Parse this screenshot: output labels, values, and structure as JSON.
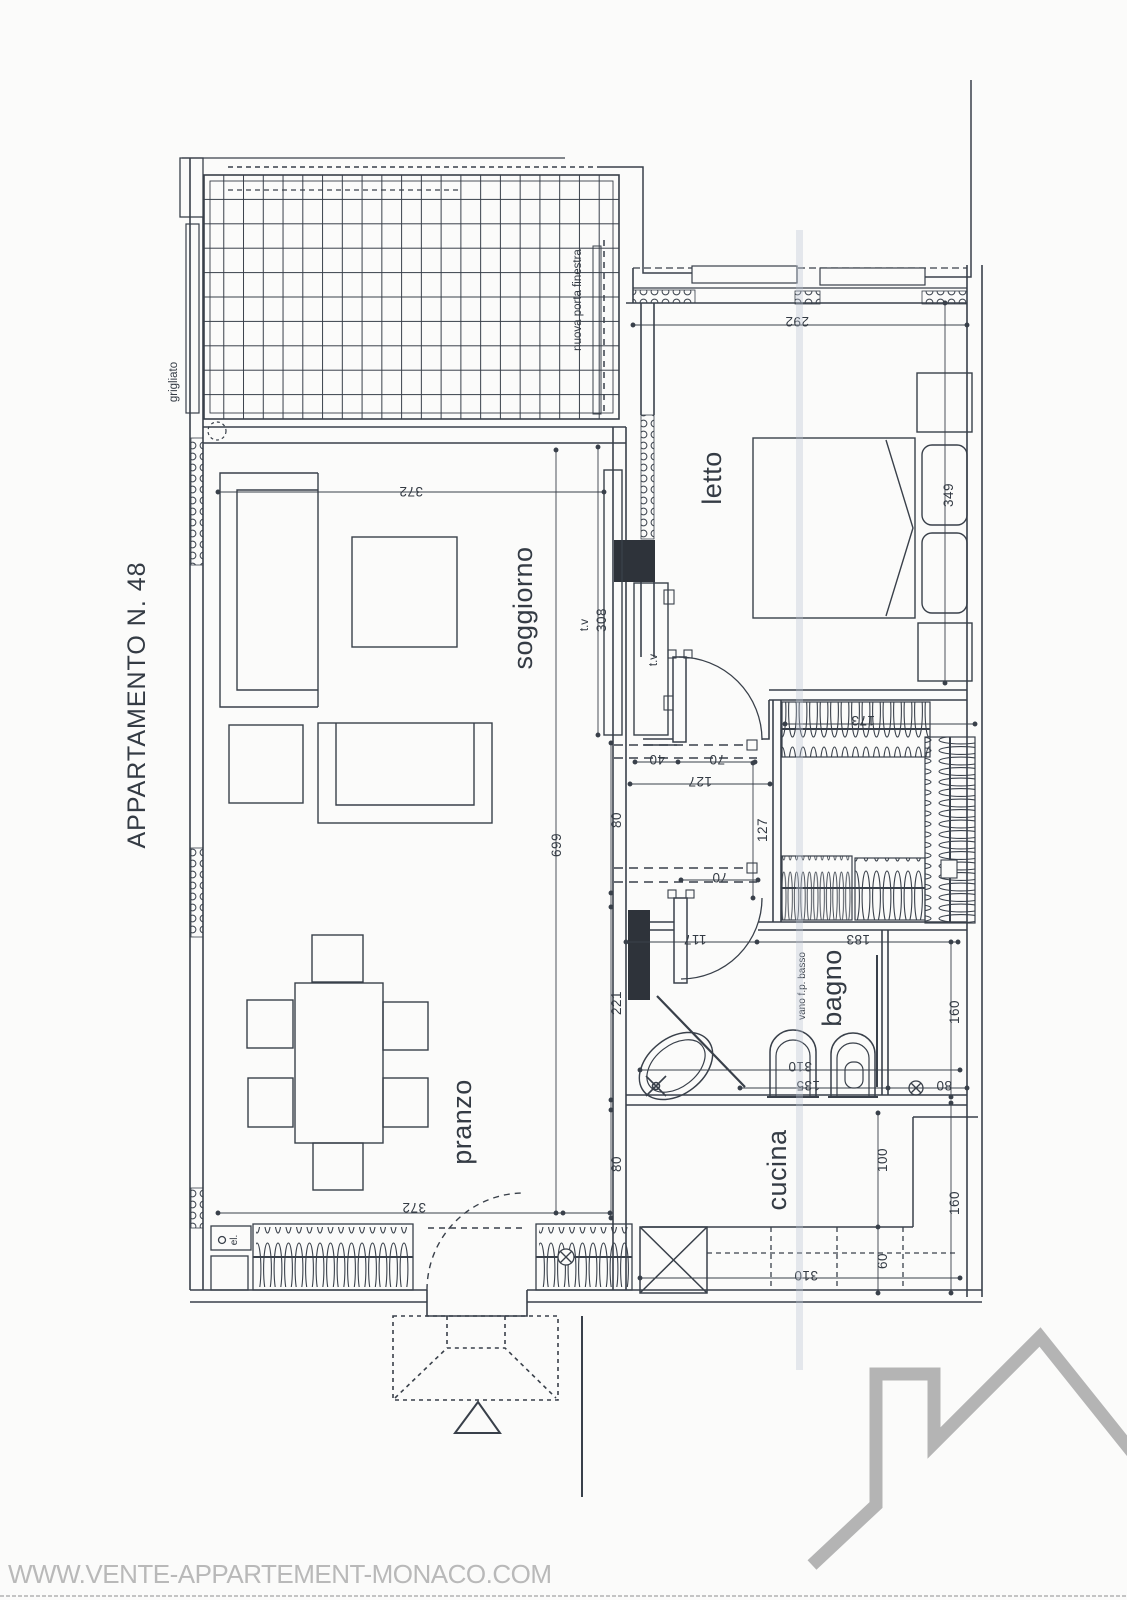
{
  "title": "APPARTAMENTO N. 48",
  "watermark": "WWW.VENTE-APPARTEMENT-MONACO.COM",
  "rooms": {
    "soggiorno": "soggiorno",
    "letto": "letto",
    "pranzo": "pranzo",
    "bagno": "bagno",
    "cucina": "cucina"
  },
  "annotations": {
    "grigliato": "grigliato",
    "nuova_porta_finestra": "nuova porta finestra",
    "vano_fp_basso": "vano f.p. basso",
    "electrical": "el.",
    "tv_soggiorno": "t.v",
    "tv_letto": "t.v"
  },
  "dimensions_cm": {
    "terrace_soggiorno_width": "372",
    "soggiorno_length": "699",
    "tv_wall": "308",
    "niche_depth": "80",
    "hallway_wall": "221",
    "lower_niche": "80",
    "pranzo_width": "372",
    "letto_width": "292",
    "letto_length": "349",
    "door_jamb": "40",
    "letto_door": "70",
    "corridor_width": "127",
    "corridor_height": "127",
    "bagno_door": "70",
    "closet_width": "173",
    "bagno_wall_left": "117",
    "bagno_wall_right": "183",
    "bagno_width": "310",
    "tub_wall": "135",
    "drain_offset": "80",
    "bagno_depth": "160",
    "cucina_counter": "100",
    "cucina_lower": "60",
    "cucina_depth": "160",
    "cucina_width": "310"
  },
  "colors": {
    "ink": "#39404a",
    "logo_gray": "#b4b4b4",
    "pillar": "#2e333a"
  }
}
